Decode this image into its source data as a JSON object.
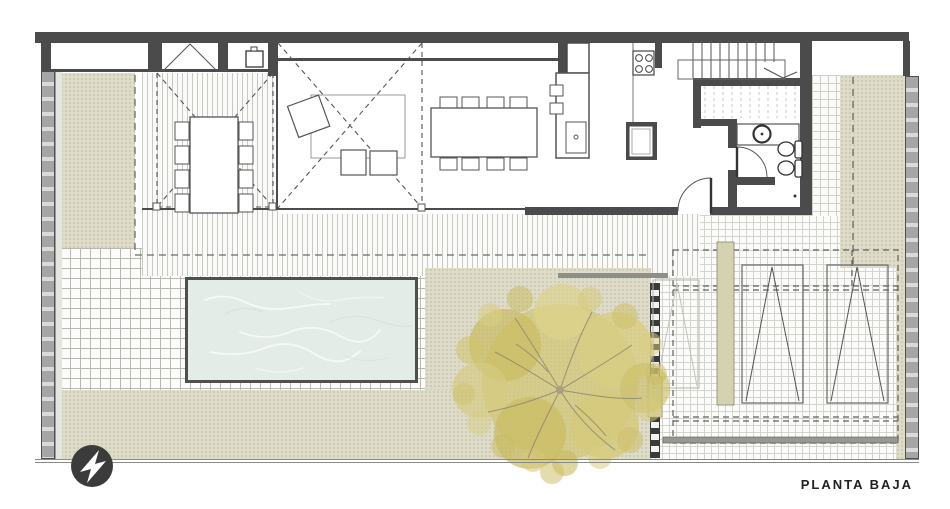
{
  "title": {
    "label": "PLANTA BAJA"
  },
  "compass": {
    "icon": "north-arrow-icon"
  },
  "colors": {
    "wall": "#4b4b4b",
    "grass": "#dedbc9",
    "water": "#e3ece7",
    "pool_border": "#4f4f4f",
    "fence": "#a5a5a5",
    "tree_yellow": "#d2c676",
    "tree_olive": "#c9bc62",
    "branch": "#8e8671",
    "planter": "#d5d2b2",
    "line": "#555555",
    "ink": "#222222"
  }
}
